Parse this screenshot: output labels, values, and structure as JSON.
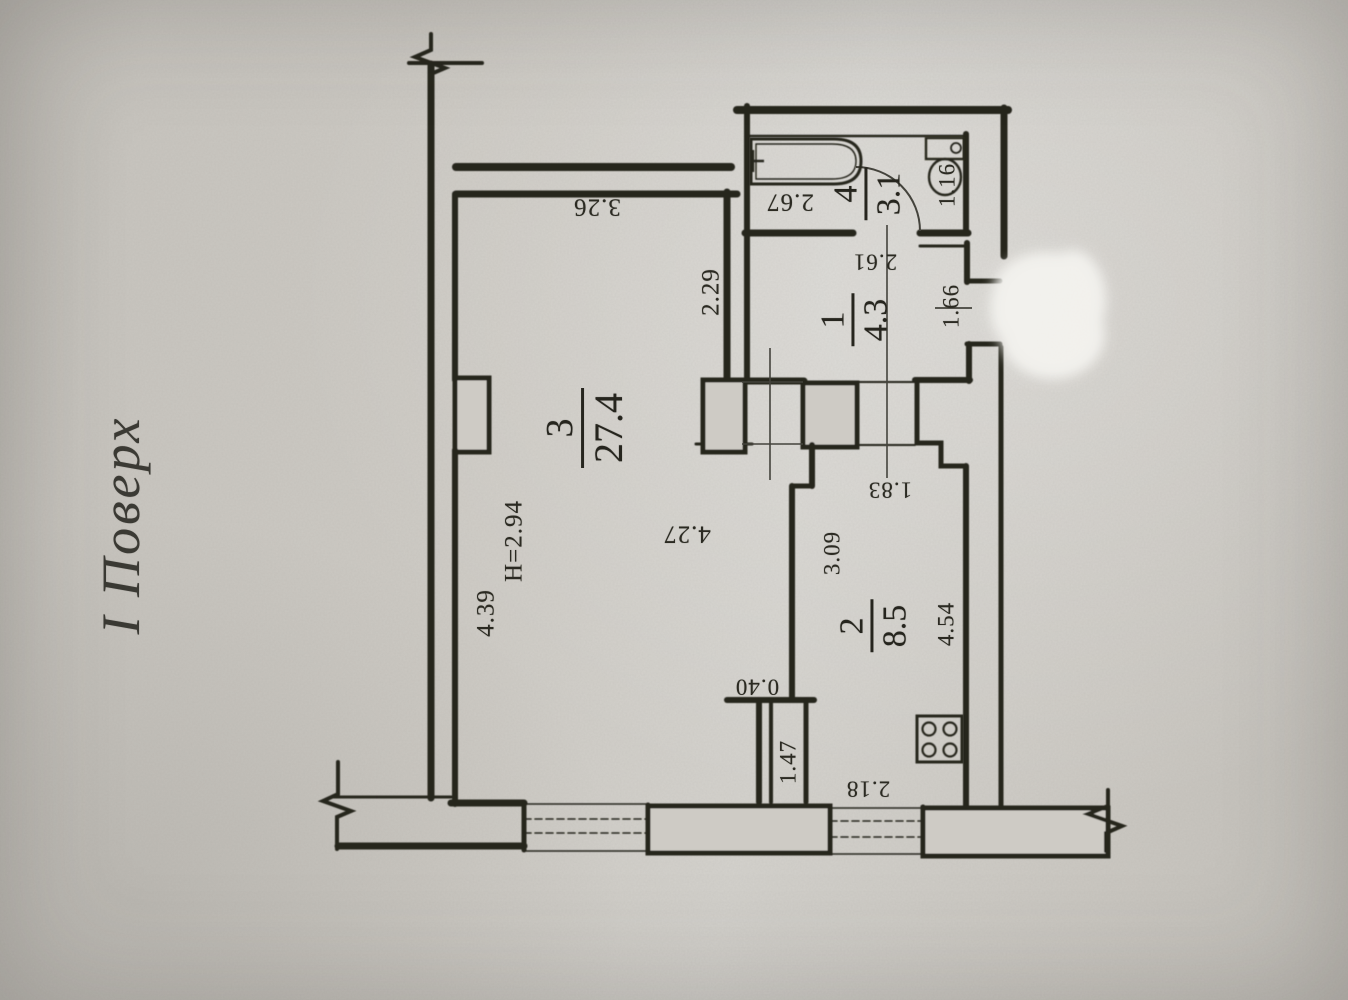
{
  "document": {
    "floor_label": "І Поверх"
  },
  "colors": {
    "paper": "#cecbc5",
    "ink": "#26251f",
    "correction_blob": "#f3f2ee"
  },
  "rooms": {
    "living": {
      "number": "3",
      "area": "27.4"
    },
    "hall": {
      "number": "1",
      "area": "4.3"
    },
    "kitchen": {
      "number": "2",
      "area": "8.5"
    },
    "bath": {
      "number": "4",
      "area": "3.1"
    }
  },
  "dimensions": {
    "room3_top_width": "3.26",
    "room3_upper_right": "2.29",
    "room3_bottom_width": "4.27",
    "room3_left_length": "4.39",
    "ceiling_height": "H=2.94",
    "room3_notch": "0.40",
    "bath_length": "2.67",
    "bath_width": "1.16",
    "hall_length": "2.61",
    "hall_width": "1.66",
    "kitchen_top_width": "1.83",
    "kitchen_left_length": "3.09",
    "kitchen_right_length": "4.54",
    "kitchen_recess": "1.47",
    "kitchen_bottom_width": "2.18"
  },
  "fixtures": [
    "bathtub-icon",
    "toilet-icon",
    "stove-icon"
  ],
  "symbols": [
    "wall-break-icon",
    "window-symbol",
    "door-swing-arc",
    "correction-fluid-blob"
  ]
}
